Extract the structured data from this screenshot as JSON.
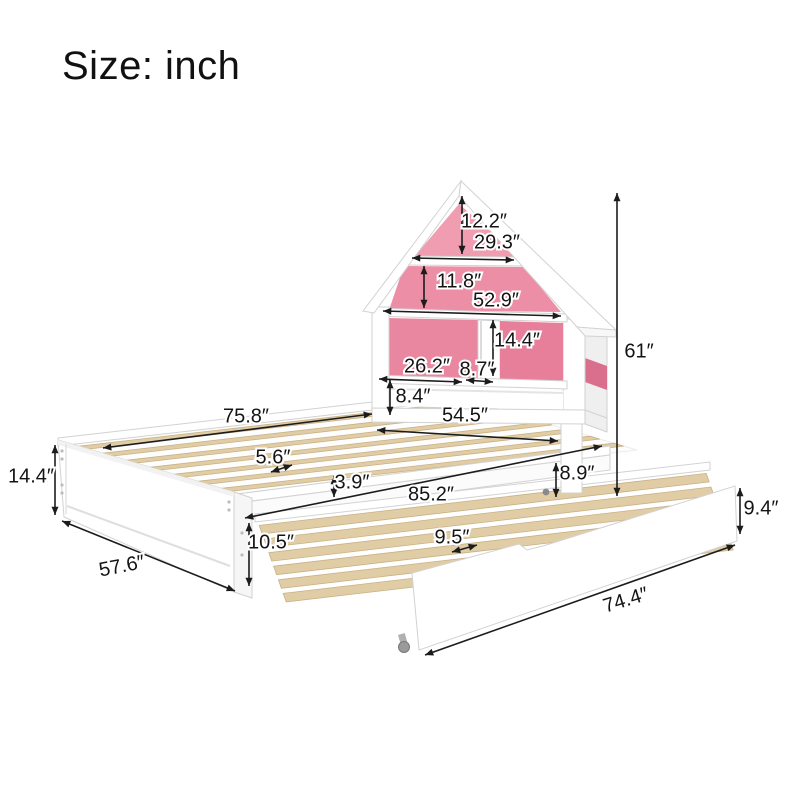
{
  "title": "Size: inch",
  "units": "inch",
  "colors": {
    "background": "#ffffff",
    "pink_attic": "#f09cb1",
    "pink_mid": "#ec8fa6",
    "pink_left_cubby": "#ea87a0",
    "pink_right_cubby": "#e87f9a",
    "pink_side": "#d96f8d",
    "slat_wood": "#e0cda6",
    "slat_edge": "#c9b184",
    "annotation": "#1c1c1c",
    "furniture_edge": "#d2d2d2"
  },
  "dimensions": [
    {
      "id": "roof-peak-height",
      "label": "12.2″",
      "lx": 484,
      "ly": 222,
      "rot": 0,
      "x1": 462,
      "y1": 196,
      "x2": 462,
      "y2": 254
    },
    {
      "id": "roof-upper-width",
      "label": "29.3″",
      "lx": 497,
      "ly": 243,
      "rot": 0,
      "x1": 412,
      "y1": 258,
      "x2": 514,
      "y2": 260
    },
    {
      "id": "gable-height",
      "label": "11.8″",
      "lx": 459,
      "ly": 282,
      "rot": 0,
      "x1": 424,
      "y1": 266,
      "x2": 424,
      "y2": 308
    },
    {
      "id": "eaves-width",
      "label": "52.9″",
      "lx": 496,
      "ly": 301,
      "rot": 0,
      "x1": 383,
      "y1": 311,
      "x2": 561,
      "y2": 316
    },
    {
      "id": "shelf-compartment-height",
      "label": "14.4″",
      "lx": 517,
      "ly": 341,
      "rot": 0,
      "x1": 493,
      "y1": 320,
      "x2": 493,
      "y2": 376
    },
    {
      "id": "left-shelf-width",
      "label": "26.2″",
      "lx": 427,
      "ly": 367,
      "rot": 0,
      "x1": 379,
      "y1": 379,
      "x2": 462,
      "y2": 382
    },
    {
      "id": "divider-shelf-width",
      "label": "8.7″",
      "lx": 477,
      "ly": 370,
      "rot": 0,
      "x1": 466,
      "y1": 380,
      "x2": 493,
      "y2": 382
    },
    {
      "id": "lower-shelf-height",
      "label": "8.4″",
      "lx": 413,
      "ly": 397,
      "rot": 0,
      "x1": 390,
      "y1": 380,
      "x2": 390,
      "y2": 415
    },
    {
      "id": "headboard-width",
      "label": "54.5″",
      "lx": 465,
      "ly": 416,
      "rot": 0,
      "x1": 377,
      "y1": 430,
      "x2": 558,
      "y2": 441
    },
    {
      "id": "total-height",
      "label": "61″",
      "lx": 639,
      "ly": 352,
      "rot": 0,
      "x1": 617,
      "y1": 193,
      "x2": 617,
      "y2": 496
    },
    {
      "id": "bed-length",
      "label": "75.8″",
      "lx": 246,
      "ly": 417,
      "rot": 0,
      "x1": 103,
      "y1": 448,
      "x2": 372,
      "y2": 414
    },
    {
      "id": "slat-spacing",
      "label": "5.6″",
      "lx": 273,
      "ly": 458,
      "rot": 0,
      "x1": 271,
      "y1": 472,
      "x2": 292,
      "y2": 465
    },
    {
      "id": "frame-height",
      "label": "14.4″",
      "lx": 31,
      "ly": 477,
      "rot": 0,
      "x1": 55,
      "y1": 445,
      "x2": 55,
      "y2": 515
    },
    {
      "id": "rail-thickness",
      "label": "3.9″",
      "lx": 352,
      "ly": 483,
      "rot": 0,
      "x1": 334,
      "y1": 476,
      "x2": 334,
      "y2": 497
    },
    {
      "id": "extended-length",
      "label": "85.2″",
      "lx": 431,
      "ly": 495,
      "rot": 0,
      "x1": 245,
      "y1": 518,
      "x2": 602,
      "y2": 446
    },
    {
      "id": "under-bed-clearance",
      "label": "8.9″",
      "lx": 577,
      "ly": 474,
      "rot": 0,
      "x1": 556,
      "y1": 463,
      "x2": 556,
      "y2": 497
    },
    {
      "id": "bed-width",
      "label": "57.6″",
      "lx": 122,
      "ly": 567,
      "rot": -11,
      "x1": 62,
      "y1": 521,
      "x2": 235,
      "y2": 591
    },
    {
      "id": "trundle-height",
      "label": "10.5″",
      "lx": 271,
      "ly": 543,
      "rot": 0,
      "x1": 249,
      "y1": 523,
      "x2": 249,
      "y2": 586
    },
    {
      "id": "trundle-slat-spacing",
      "label": "9.5″",
      "lx": 452,
      "ly": 538,
      "rot": 0,
      "x1": 452,
      "y1": 552,
      "x2": 477,
      "y2": 545
    },
    {
      "id": "trundle-panel-height",
      "label": "9.4″",
      "lx": 761,
      "ly": 509,
      "rot": 0,
      "x1": 740,
      "y1": 488,
      "x2": 740,
      "y2": 534
    },
    {
      "id": "trundle-length",
      "label": "74.4″",
      "lx": 626,
      "ly": 601,
      "rot": -17,
      "x1": 425,
      "y1": 655,
      "x2": 735,
      "y2": 545
    }
  ]
}
